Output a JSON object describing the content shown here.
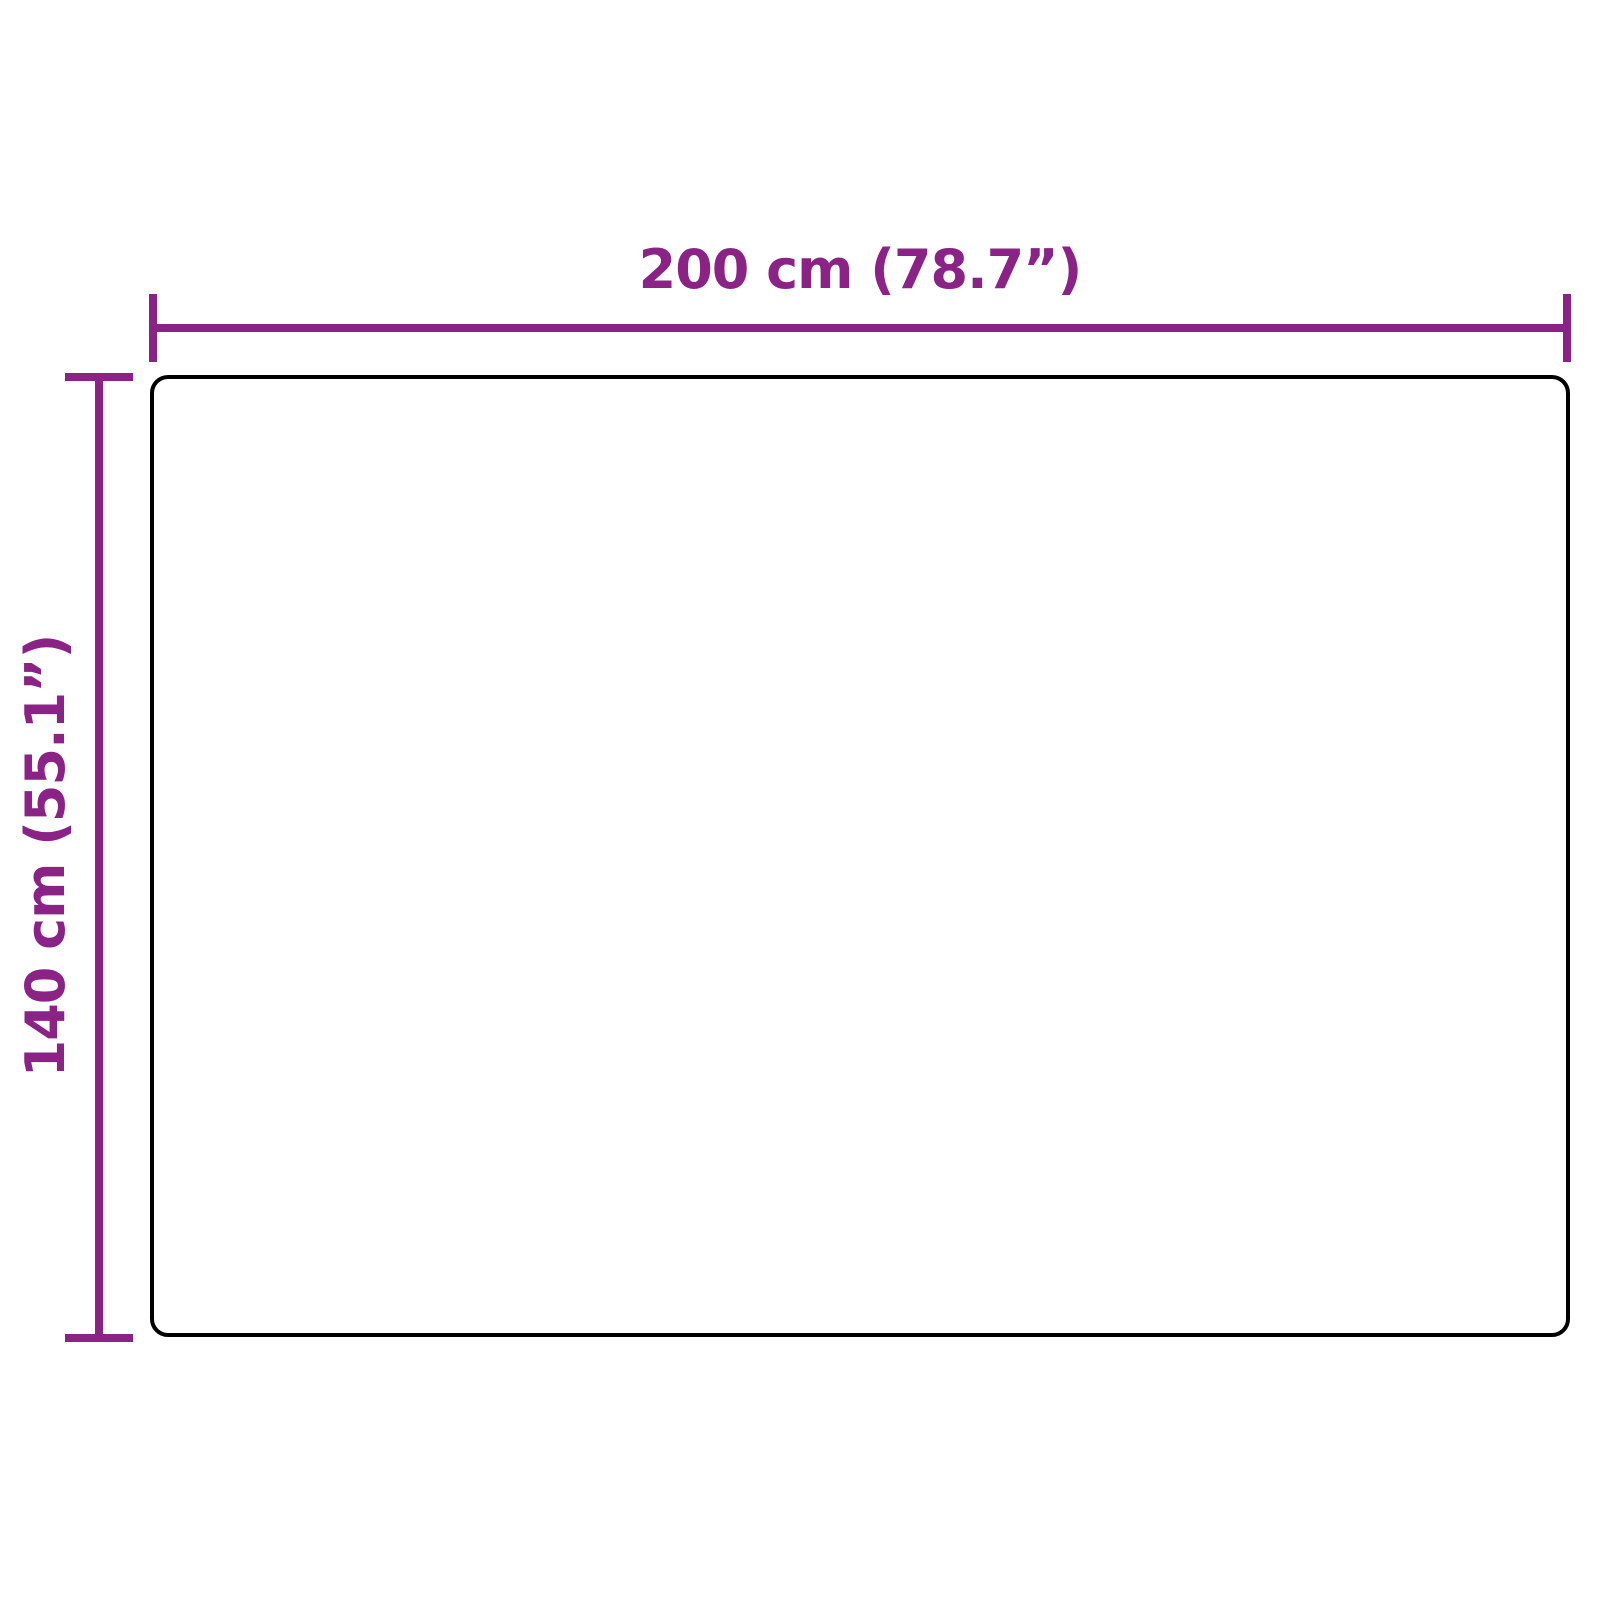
{
  "figure": {
    "type": "dimension-diagram",
    "object": "rectangle-outline",
    "width_label": "200 cm (78.7”)",
    "height_label": "140 cm (55.1”)"
  },
  "colors": {
    "dimension_accent": "#8B2386",
    "outline": "#000000",
    "background": "#FFFFFF"
  }
}
